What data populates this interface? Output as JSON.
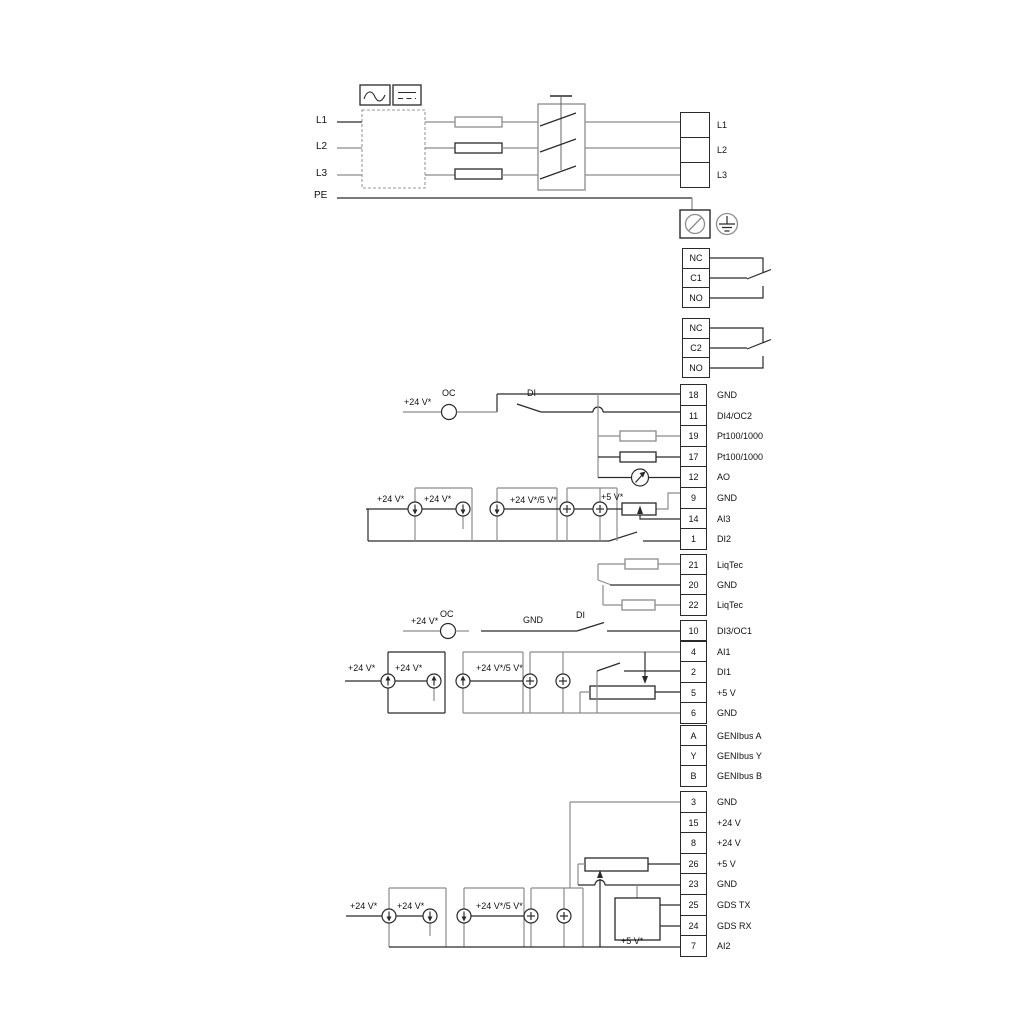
{
  "colors": {
    "wire_gray": "#8C8C8C",
    "wire_black": "#2A2A2A",
    "background": "#FFFFFF"
  },
  "icons": {
    "ac": "ac-waveform-icon",
    "dc": "dc-symbol-icon",
    "earth_terminal": "earth-terminal-icon",
    "protective_earth": "protective-earth-icon",
    "analog_output": "analog-output-meter-icon",
    "current_source": "current-source-icon",
    "voltage_source": "voltage-source-icon"
  },
  "power_in": {
    "l1": "L1",
    "l2": "L2",
    "l3": "L3",
    "pe": "PE"
  },
  "mains_out": {
    "rows": [
      {
        "label": "L1"
      },
      {
        "label": "L2"
      },
      {
        "label": "L3"
      }
    ]
  },
  "relay1": {
    "rows": [
      {
        "label": "NC"
      },
      {
        "label": "C1"
      },
      {
        "label": "NO"
      }
    ]
  },
  "relay2": {
    "rows": [
      {
        "label": "NC"
      },
      {
        "label": "C2"
      },
      {
        "label": "NO"
      }
    ]
  },
  "strip_a": {
    "rows": [
      {
        "num": "18",
        "label": "GND"
      },
      {
        "num": "11",
        "label": "DI4/OC2"
      },
      {
        "num": "19",
        "label": "Pt100/1000"
      },
      {
        "num": "17",
        "label": "Pt100/1000"
      },
      {
        "num": "12",
        "label": "AO"
      },
      {
        "num": "9",
        "label": "GND"
      },
      {
        "num": "14",
        "label": "AI3"
      },
      {
        "num": "1",
        "label": "DI2"
      }
    ]
  },
  "strip_liqtec": {
    "rows": [
      {
        "num": "21",
        "label": "LiqTec"
      },
      {
        "num": "20",
        "label": "GND"
      },
      {
        "num": "22",
        "label": "LiqTec"
      }
    ]
  },
  "strip_di3": {
    "num": "10",
    "label": "DI3/OC1"
  },
  "strip_b": {
    "rows": [
      {
        "num": "4",
        "label": "AI1"
      },
      {
        "num": "2",
        "label": "DI1"
      },
      {
        "num": "5",
        "label": "+5 V"
      },
      {
        "num": "6",
        "label": "GND"
      }
    ]
  },
  "strip_genibus": {
    "rows": [
      {
        "num": "A",
        "label": "GENIbus A"
      },
      {
        "num": "Y",
        "label": "GENIbus Y"
      },
      {
        "num": "B",
        "label": "GENIbus B"
      }
    ]
  },
  "strip_c": {
    "rows": [
      {
        "num": "3",
        "label": "GND"
      },
      {
        "num": "15",
        "label": "+24 V"
      },
      {
        "num": "8",
        "label": "+24 V"
      },
      {
        "num": "26",
        "label": "+5 V"
      },
      {
        "num": "23",
        "label": "GND"
      },
      {
        "num": "25",
        "label": "GDS TX"
      },
      {
        "num": "24",
        "label": "GDS RX"
      },
      {
        "num": "7",
        "label": "AI2"
      }
    ]
  },
  "labels": {
    "plus24": "+24 V*",
    "plus24or5": "+24 V*/5 V*",
    "plus5": "+5 V*",
    "oc": "OC",
    "di": "DI",
    "gnd": "GND"
  }
}
